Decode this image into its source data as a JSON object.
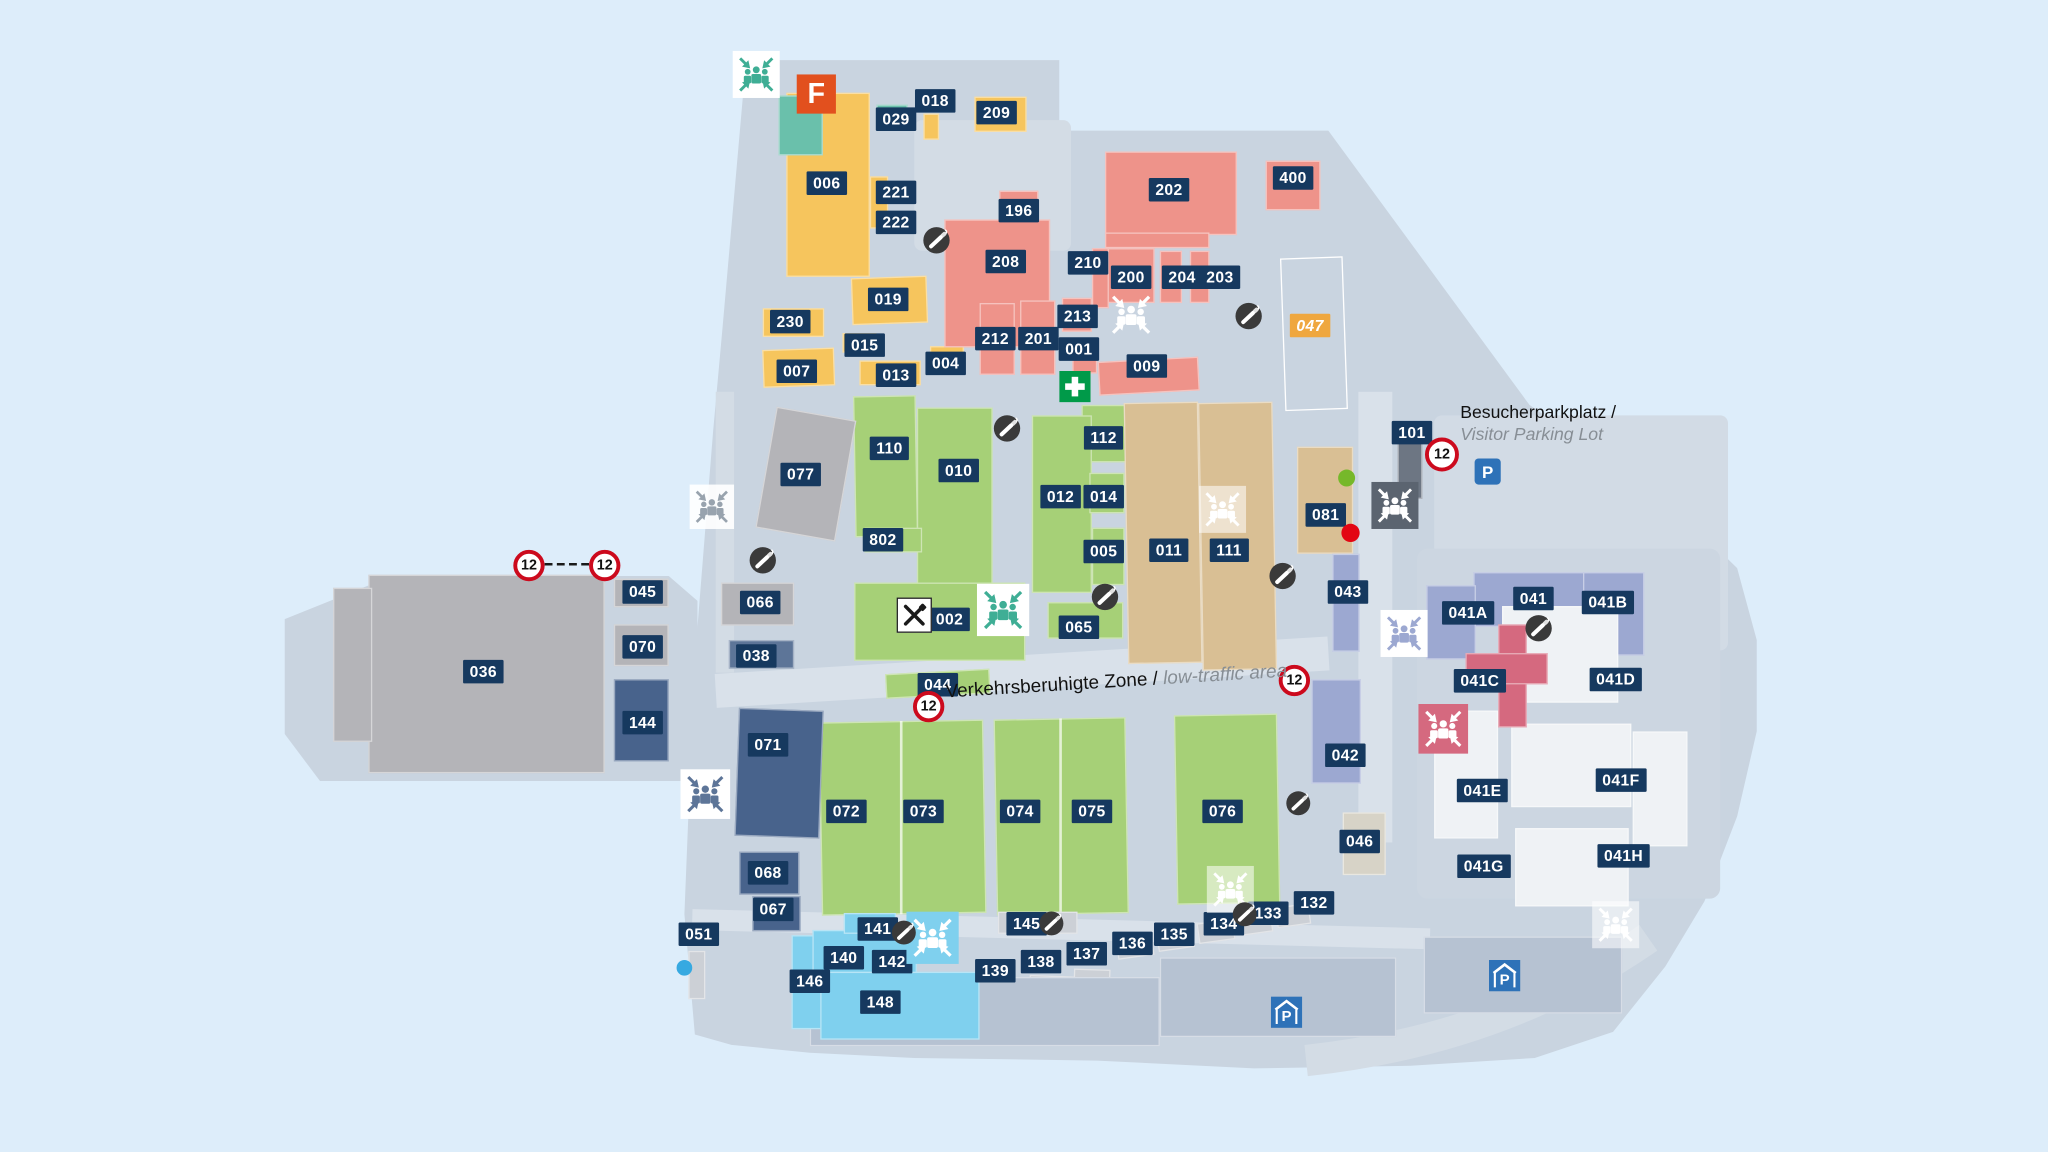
{
  "map_title": "site-plan",
  "colors": {
    "page_bg": "#ddedfa",
    "map_fill": "#c9d4e0",
    "road_fill": "#d9e1ea",
    "label_bg": "#16395f",
    "label_orange_bg": "#efa73f",
    "building_palette": {
      "yellow": "#f6c55d",
      "teal": "#6ac0ab",
      "salmon": "#ee938a",
      "green": "#a6d077",
      "tan": "#d9bf94",
      "gray": "#b4b4b8",
      "lightgray": "#ccd0d6",
      "beige": "#d7d3c7",
      "darkblue": "#48638c",
      "steel": "#5d7598",
      "lightblue": "#7fd0ee",
      "lavender": "#9ca8d1",
      "pink": "#d5697f",
      "white": "#eff2f5",
      "darkgray": "#6d7683",
      "slab": "#b6c2d2",
      "div": "rgba(255,255,255,0.7)",
      "outline": "transparent"
    },
    "meeting_variants": {
      "green": {
        "bg": "#ffffff",
        "fg": "#3fae95"
      },
      "onyellow": {
        "bg": "transparent",
        "fg": "#ffffff"
      },
      "white": {
        "bg": "rgba(255,255,255,0.55)",
        "fg": "#ffffff"
      },
      "gray": {
        "bg": "rgba(255,255,255,0.9)",
        "fg": "#98a3ae"
      },
      "dark": {
        "bg": "#5b6470",
        "fg": "#ffffff"
      },
      "lavender": {
        "bg": "#ffffff",
        "fg": "#9ca8d1"
      },
      "pink": {
        "bg": "#d5697f",
        "fg": "#ffffff"
      },
      "steel": {
        "bg": "#ffffff",
        "fg": "#5d7598"
      },
      "lightblue": {
        "bg": "#7fd0ee",
        "fg": "#ffffff"
      }
    },
    "dot_colors": {
      "green": "#76b82a",
      "red": "#e30613",
      "blue": "#36a9e1"
    },
    "sign_red": "#cc0a1d",
    "parking_blue": "#2e72b8",
    "first_aid_green": "#009a49",
    "smoking_dark": "#3a3a3a",
    "logo_orange": "#e2501e"
  },
  "glyph_text": {
    "parking": "P",
    "speed_limit": "12",
    "site_logo": "F"
  },
  "texts": {
    "besucher": {
      "line1": "Besucherparkplatz /",
      "line2": "Visitor Parking Lot"
    },
    "zone": {
      "line1": "Verkehrsberuhigte Zone / ",
      "line2": "low-traffic area"
    }
  },
  "buildings": [
    [
      602,
      71,
      64,
      141,
      "yellow"
    ],
    [
      596,
      73,
      34,
      46,
      "teal"
    ],
    [
      666,
      135,
      14,
      40,
      "yellow"
    ],
    [
      671,
      80,
      24,
      20,
      "teal"
    ],
    [
      707,
      87,
      12,
      20,
      "yellow"
    ],
    [
      746,
      74,
      40,
      27,
      "yellow"
    ],
    [
      652,
      212,
      58,
      36,
      "yellow",
      -2
    ],
    [
      584,
      236,
      47,
      22,
      "yellow"
    ],
    [
      584,
      267,
      55,
      29,
      "yellow",
      -2
    ],
    [
      645,
      255,
      26,
      15,
      "yellow"
    ],
    [
      658,
      276,
      47,
      19,
      "yellow"
    ],
    [
      712,
      265,
      26,
      16,
      "yellow"
    ],
    [
      846,
      116,
      101,
      64,
      "salmon"
    ],
    [
      969,
      123,
      42,
      38,
      "salmon"
    ],
    [
      765,
      146,
      30,
      28,
      "salmon"
    ],
    [
      723,
      168,
      81,
      98,
      "salmon"
    ],
    [
      750,
      232,
      27,
      55,
      "salmon"
    ],
    [
      781,
      230,
      27,
      57,
      "salmon"
    ],
    [
      813,
      228,
      23,
      26,
      "salmon"
    ],
    [
      821,
      262,
      19,
      24,
      "salmon"
    ],
    [
      841,
      275,
      77,
      26,
      "salmon",
      -3
    ],
    [
      846,
      178,
      80,
      12,
      "salmon"
    ],
    [
      846,
      190,
      38,
      42,
      "salmon"
    ],
    [
      888,
      192,
      17,
      40,
      "salmon"
    ],
    [
      911,
      192,
      15,
      40,
      "salmon"
    ],
    [
      836,
      190,
      13,
      46,
      "salmon"
    ],
    [
      654,
      303,
      48,
      108,
      "green",
      -1
    ],
    [
      702,
      312,
      58,
      136,
      "green"
    ],
    [
      662,
      404,
      44,
      19,
      "green"
    ],
    [
      828,
      310,
      39,
      44,
      "green"
    ],
    [
      790,
      318,
      46,
      136,
      "green"
    ],
    [
      834,
      362,
      27,
      31,
      "green"
    ],
    [
      836,
      404,
      25,
      44,
      "green"
    ],
    [
      802,
      461,
      58,
      28,
      "green"
    ],
    [
      654,
      446,
      131,
      60,
      "green"
    ],
    [
      678,
      514,
      80,
      19,
      "green",
      -3
    ],
    [
      628,
      552,
      126,
      148,
      "green",
      -1
    ],
    [
      762,
      550,
      101,
      150,
      "green",
      -1
    ],
    [
      900,
      547,
      79,
      145,
      "green",
      -1
    ],
    [
      689,
      552,
      2,
      148,
      "div"
    ],
    [
      811,
      550,
      2,
      150,
      "div"
    ],
    [
      862,
      308,
      57,
      200,
      "tan",
      -1
    ],
    [
      919,
      308,
      57,
      205,
      "tan",
      -1
    ],
    [
      993,
      342,
      43,
      82,
      "tan"
    ],
    [
      586,
      316,
      62,
      94,
      "gray",
      10
    ],
    [
      282,
      440,
      181,
      152,
      "gray"
    ],
    [
      255,
      450,
      30,
      118,
      "gray"
    ],
    [
      470,
      443,
      42,
      22,
      "gray"
    ],
    [
      470,
      478,
      42,
      32,
      "gray"
    ],
    [
      552,
      446,
      56,
      33,
      "gray"
    ],
    [
      764,
      698,
      61,
      17,
      "lightgray"
    ],
    [
      855,
      717,
      28,
      16,
      "lightgray",
      -8
    ],
    [
      886,
      711,
      28,
      16,
      "lightgray",
      -8
    ],
    [
      917,
      705,
      28,
      16,
      "lightgray",
      -8
    ],
    [
      948,
      699,
      26,
      16,
      "lightgray",
      -8
    ],
    [
      977,
      693,
      26,
      16,
      "lightgray",
      -8
    ],
    [
      750,
      751,
      36,
      21,
      "lightgray",
      2
    ],
    [
      788,
      747,
      34,
      20,
      "lightgray",
      2
    ],
    [
      822,
      742,
      28,
      18,
      "lightgray",
      2
    ],
    [
      527,
      728,
      13,
      37,
      "lightgray"
    ],
    [
      620,
      748,
      268,
      53,
      "slab"
    ],
    [
      888,
      733,
      181,
      61,
      "slab"
    ],
    [
      1090,
      717,
      152,
      59,
      "slab"
    ],
    [
      1028,
      622,
      33,
      48,
      "beige"
    ],
    [
      1070,
      336,
      19,
      46,
      "darkgray"
    ],
    [
      470,
      520,
      42,
      63,
      "darkblue"
    ],
    [
      558,
      490,
      50,
      22,
      "steel"
    ],
    [
      564,
      543,
      65,
      98,
      "darkblue",
      2
    ],
    [
      566,
      652,
      46,
      33,
      "darkblue"
    ],
    [
      576,
      686,
      37,
      27,
      "darkblue"
    ],
    [
      606,
      716,
      36,
      72,
      "lightblue"
    ],
    [
      622,
      712,
      80,
      33,
      "lightblue"
    ],
    [
      628,
      744,
      122,
      52,
      "lightblue"
    ],
    [
      646,
      699,
      40,
      16,
      "lightblue"
    ],
    [
      1020,
      424,
      21,
      75,
      "lavender"
    ],
    [
      1004,
      520,
      38,
      80,
      "lavender"
    ],
    [
      1128,
      438,
      86,
      42,
      "lavender"
    ],
    [
      1092,
      448,
      38,
      57,
      "lavender"
    ],
    [
      1212,
      438,
      47,
      64,
      "lavender"
    ],
    [
      1150,
      464,
      89,
      74,
      "white"
    ],
    [
      1098,
      544,
      49,
      98,
      "white"
    ],
    [
      1157,
      554,
      92,
      64,
      "white"
    ],
    [
      1160,
      634,
      87,
      60,
      "white"
    ],
    [
      1250,
      560,
      42,
      88,
      "white"
    ],
    [
      1147,
      478,
      22,
      79,
      "pink"
    ],
    [
      1122,
      500,
      63,
      24,
      "pink"
    ],
    [
      982,
      197,
      48,
      117,
      "outline",
      -2
    ]
  ],
  "labels": [
    [
      "006",
      633,
      140
    ],
    [
      "018",
      716,
      77
    ],
    [
      "029",
      686,
      91
    ],
    [
      "209",
      763,
      86
    ],
    [
      "221",
      686,
      147
    ],
    [
      "222",
      686,
      170
    ],
    [
      "196",
      780,
      161
    ],
    [
      "202",
      895,
      145
    ],
    [
      "400",
      990,
      136
    ],
    [
      "208",
      770,
      200
    ],
    [
      "210",
      833,
      201
    ],
    [
      "200",
      866,
      212
    ],
    [
      "204",
      905,
      212
    ],
    [
      "203",
      934,
      212
    ],
    [
      "213",
      825,
      242
    ],
    [
      "019",
      680,
      229
    ],
    [
      "230",
      605,
      246
    ],
    [
      "007",
      610,
      284
    ],
    [
      "015",
      662,
      264
    ],
    [
      "013",
      686,
      287
    ],
    [
      "004",
      724,
      278
    ],
    [
      "212",
      762,
      259
    ],
    [
      "201",
      795,
      259
    ],
    [
      "001",
      826,
      267
    ],
    [
      "009",
      878,
      280
    ],
    [
      "047",
      1003,
      249,
      "o"
    ],
    [
      "110",
      681,
      343
    ],
    [
      "010",
      734,
      360
    ],
    [
      "112",
      845,
      335
    ],
    [
      "101",
      1081,
      331
    ],
    [
      "077",
      613,
      363
    ],
    [
      "012",
      812,
      380
    ],
    [
      "014",
      845,
      380
    ],
    [
      "081",
      1015,
      394
    ],
    [
      "802",
      676,
      413
    ],
    [
      "005",
      845,
      422
    ],
    [
      "011",
      895,
      421
    ],
    [
      "111",
      941,
      421
    ],
    [
      "043",
      1032,
      453
    ],
    [
      "045",
      492,
      453
    ],
    [
      "066",
      582,
      461
    ],
    [
      "041A",
      1124,
      469
    ],
    [
      "041",
      1174,
      458
    ],
    [
      "041B",
      1231,
      461
    ],
    [
      "002",
      727,
      474
    ],
    [
      "065",
      826,
      480
    ],
    [
      "070",
      492,
      495
    ],
    [
      "038",
      579,
      502
    ],
    [
      "036",
      370,
      514
    ],
    [
      "041C",
      1133,
      521
    ],
    [
      "041D",
      1237,
      520
    ],
    [
      "044",
      718,
      524
    ],
    [
      "144",
      492,
      553
    ],
    [
      "042",
      1030,
      578
    ],
    [
      "071",
      588,
      570
    ],
    [
      "041E",
      1135,
      605
    ],
    [
      "041F",
      1241,
      597
    ],
    [
      "072",
      648,
      621
    ],
    [
      "073",
      707,
      621
    ],
    [
      "074",
      781,
      621
    ],
    [
      "075",
      836,
      621
    ],
    [
      "076",
      936,
      621
    ],
    [
      "046",
      1041,
      644
    ],
    [
      "041G",
      1136,
      663
    ],
    [
      "041H",
      1243,
      655
    ],
    [
      "068",
      588,
      668
    ],
    [
      "067",
      592,
      696
    ],
    [
      "051",
      535,
      715
    ],
    [
      "141",
      672,
      711
    ],
    [
      "145",
      786,
      707
    ],
    [
      "133",
      971,
      699
    ],
    [
      "132",
      1006,
      691
    ],
    [
      "134",
      937,
      707
    ],
    [
      "135",
      899,
      715
    ],
    [
      "136",
      867,
      722
    ],
    [
      "140",
      646,
      733
    ],
    [
      "142",
      683,
      736
    ],
    [
      "137",
      832,
      730
    ],
    [
      "138",
      797,
      736
    ],
    [
      "139",
      762,
      743
    ],
    [
      "146",
      620,
      751
    ],
    [
      "148",
      674,
      767
    ]
  ],
  "icons": [
    {
      "k": "meeting",
      "v": "green",
      "x": 579,
      "y": 57,
      "s": 36
    },
    {
      "k": "flogo",
      "x": 625,
      "y": 72,
      "s": 30
    },
    {
      "k": "smoking",
      "x": 717,
      "y": 184,
      "s": 22
    },
    {
      "k": "meeting",
      "v": "onyellow",
      "x": 866,
      "y": 241,
      "s": 40
    },
    {
      "k": "smoking",
      "x": 956,
      "y": 242,
      "s": 22
    },
    {
      "k": "firstaid",
      "x": 823,
      "y": 296,
      "s": 24
    },
    {
      "k": "smoking",
      "x": 771,
      "y": 328,
      "s": 22
    },
    {
      "k": "meeting",
      "v": "dark",
      "x": 1068,
      "y": 387,
      "s": 36
    },
    {
      "k": "meeting",
      "v": "white",
      "x": 936,
      "y": 390,
      "s": 36
    },
    {
      "k": "meeting",
      "v": "gray",
      "x": 545,
      "y": 388,
      "s": 34
    },
    {
      "k": "smoking",
      "x": 584,
      "y": 429,
      "s": 22
    },
    {
      "k": "smoking",
      "x": 982,
      "y": 441,
      "s": 22
    },
    {
      "k": "smoking",
      "x": 846,
      "y": 457,
      "s": 22
    },
    {
      "k": "restaurant",
      "x": 700,
      "y": 471,
      "s": 27
    },
    {
      "k": "meeting",
      "v": "green",
      "x": 768,
      "y": 467,
      "s": 40
    },
    {
      "k": "meeting",
      "v": "lavender",
      "x": 1075,
      "y": 485,
      "s": 36
    },
    {
      "k": "smoking",
      "x": 1178,
      "y": 481,
      "s": 22
    },
    {
      "k": "sign12",
      "x": 405,
      "y": 433,
      "s": 24
    },
    {
      "k": "dashline",
      "x": 434,
      "y": 432,
      "s": 34
    },
    {
      "k": "sign12",
      "x": 463,
      "y": 433,
      "s": 24
    },
    {
      "k": "sign12",
      "x": 1104,
      "y": 348,
      "s": 26
    },
    {
      "k": "dot",
      "v": "green",
      "x": 1031,
      "y": 366,
      "s": 13
    },
    {
      "k": "dot",
      "v": "red",
      "x": 1034,
      "y": 408,
      "s": 14
    },
    {
      "k": "meeting",
      "v": "pink",
      "x": 1105,
      "y": 558,
      "s": 38
    },
    {
      "k": "sign12",
      "x": 711,
      "y": 541,
      "s": 24
    },
    {
      "k": "sign12",
      "x": 991,
      "y": 521,
      "s": 24
    },
    {
      "k": "meeting",
      "v": "steel",
      "x": 540,
      "y": 608,
      "s": 38
    },
    {
      "k": "dot",
      "v": "blue",
      "x": 524,
      "y": 741,
      "s": 12
    },
    {
      "k": "meeting",
      "v": "lightblue",
      "x": 714,
      "y": 718,
      "s": 40
    },
    {
      "k": "smoking",
      "x": 692,
      "y": 714,
      "s": 20
    },
    {
      "k": "smoking",
      "x": 805,
      "y": 707,
      "s": 20
    },
    {
      "k": "smoking",
      "x": 994,
      "y": 615,
      "s": 20
    },
    {
      "k": "meeting",
      "v": "white",
      "x": 942,
      "y": 681,
      "s": 36
    },
    {
      "k": "smoking",
      "x": 953,
      "y": 700,
      "s": 20
    },
    {
      "k": "meeting",
      "v": "white",
      "x": 1237,
      "y": 708,
      "s": 36
    },
    {
      "k": "parking",
      "x": 1139,
      "y": 361,
      "s": 20
    },
    {
      "k": "pgarage",
      "x": 985,
      "y": 775,
      "s": 24
    },
    {
      "k": "pgarage",
      "x": 1152,
      "y": 747,
      "s": 24
    }
  ]
}
